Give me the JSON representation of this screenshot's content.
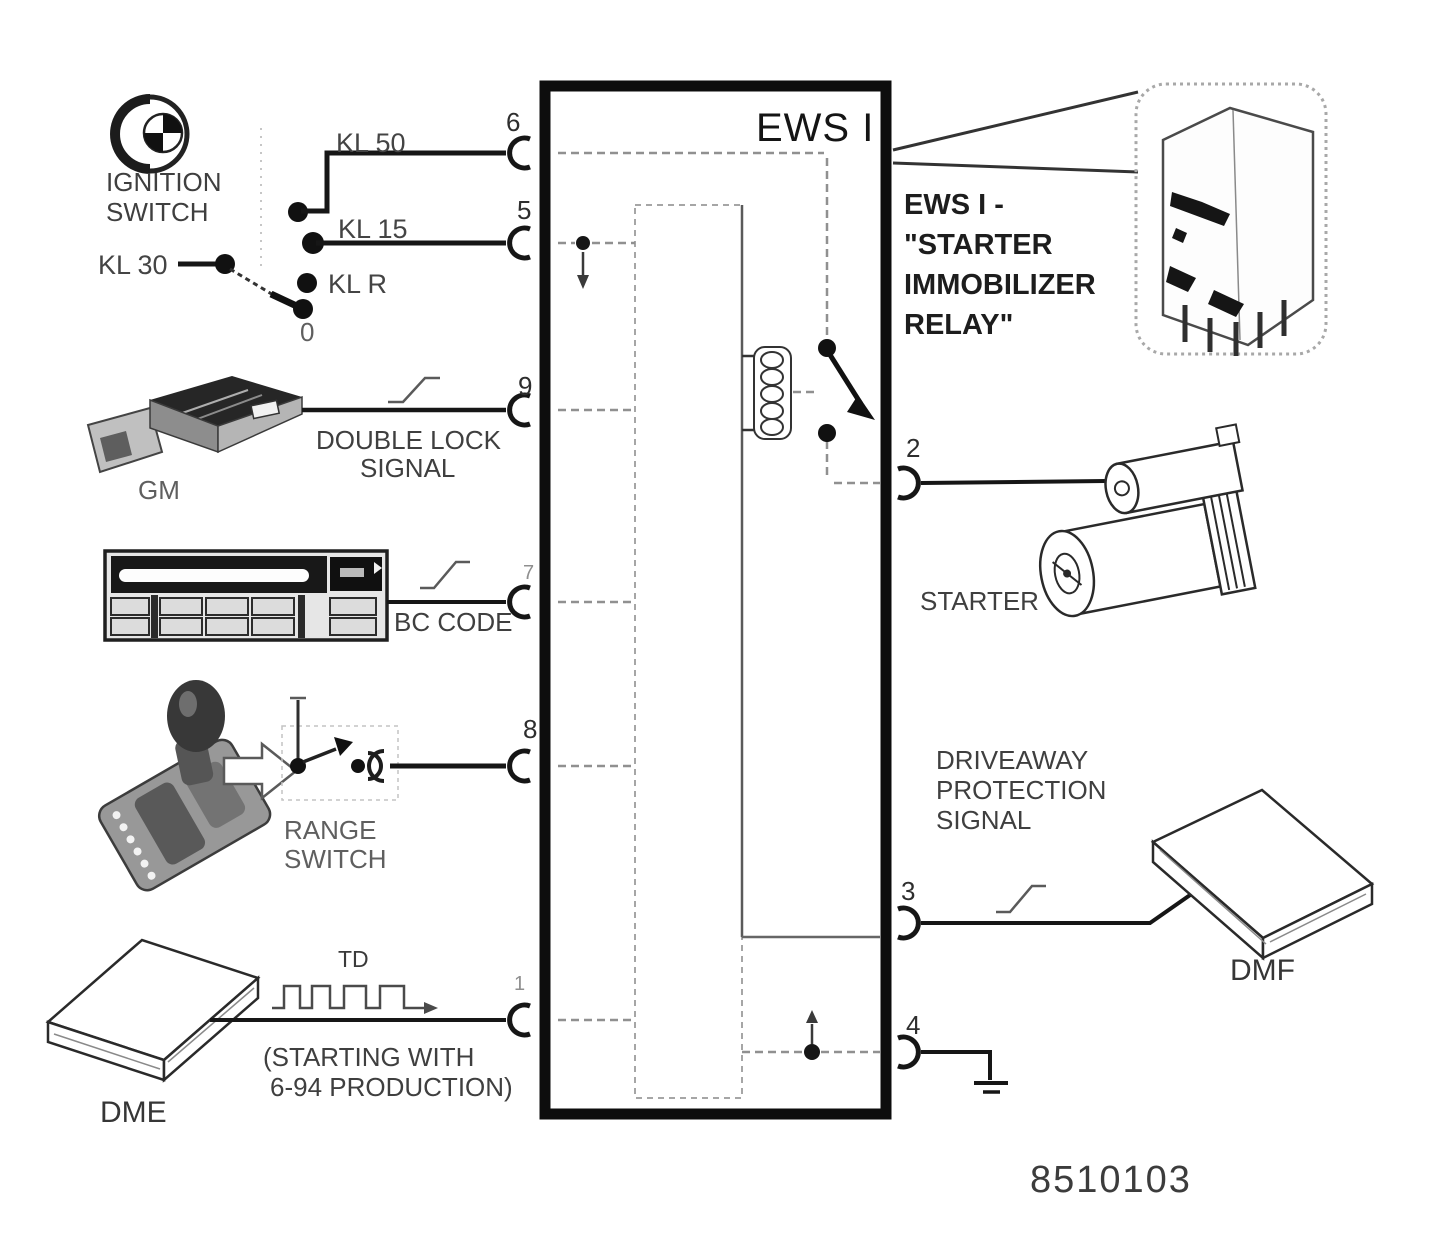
{
  "diagram": {
    "box_label": "EWS I",
    "figure_number": "8510103",
    "colors": {
      "ink": "#1a1a1a",
      "faded_trace": "#909090",
      "paper": "#ffffff"
    }
  },
  "ignition": {
    "title1": "IGNITION",
    "title2": "SWITCH",
    "kl30": "KL 30",
    "kl50": "KL 50",
    "kl15": "KL 15",
    "klr": "KL R",
    "pos0": "0"
  },
  "gm": {
    "name": "GM",
    "sig1": "DOUBLE LOCK",
    "sig2": "SIGNAL"
  },
  "bc": {
    "name": "BC CODE"
  },
  "range": {
    "name1": "RANGE",
    "name2": "SWITCH"
  },
  "dme": {
    "name": "DME",
    "sig": "TD",
    "note1": "(STARTING WITH",
    "note2": "6-94 PRODUCTION)"
  },
  "starter": {
    "name": "STARTER"
  },
  "dmf": {
    "name": "DMF",
    "sig1": "DRIVEAWAY",
    "sig2": "PROTECTION",
    "sig3": "SIGNAL"
  },
  "relay": {
    "callout1": "EWS I -",
    "callout2": "\"STARTER",
    "callout3": "IMMOBILIZER",
    "callout4": "RELAY\""
  },
  "pins": {
    "p6": "6",
    "p5": "5",
    "p9": "9",
    "p7": "7",
    "p8": "8",
    "p1": "1",
    "p2": "2",
    "p3": "3",
    "p4": "4"
  }
}
